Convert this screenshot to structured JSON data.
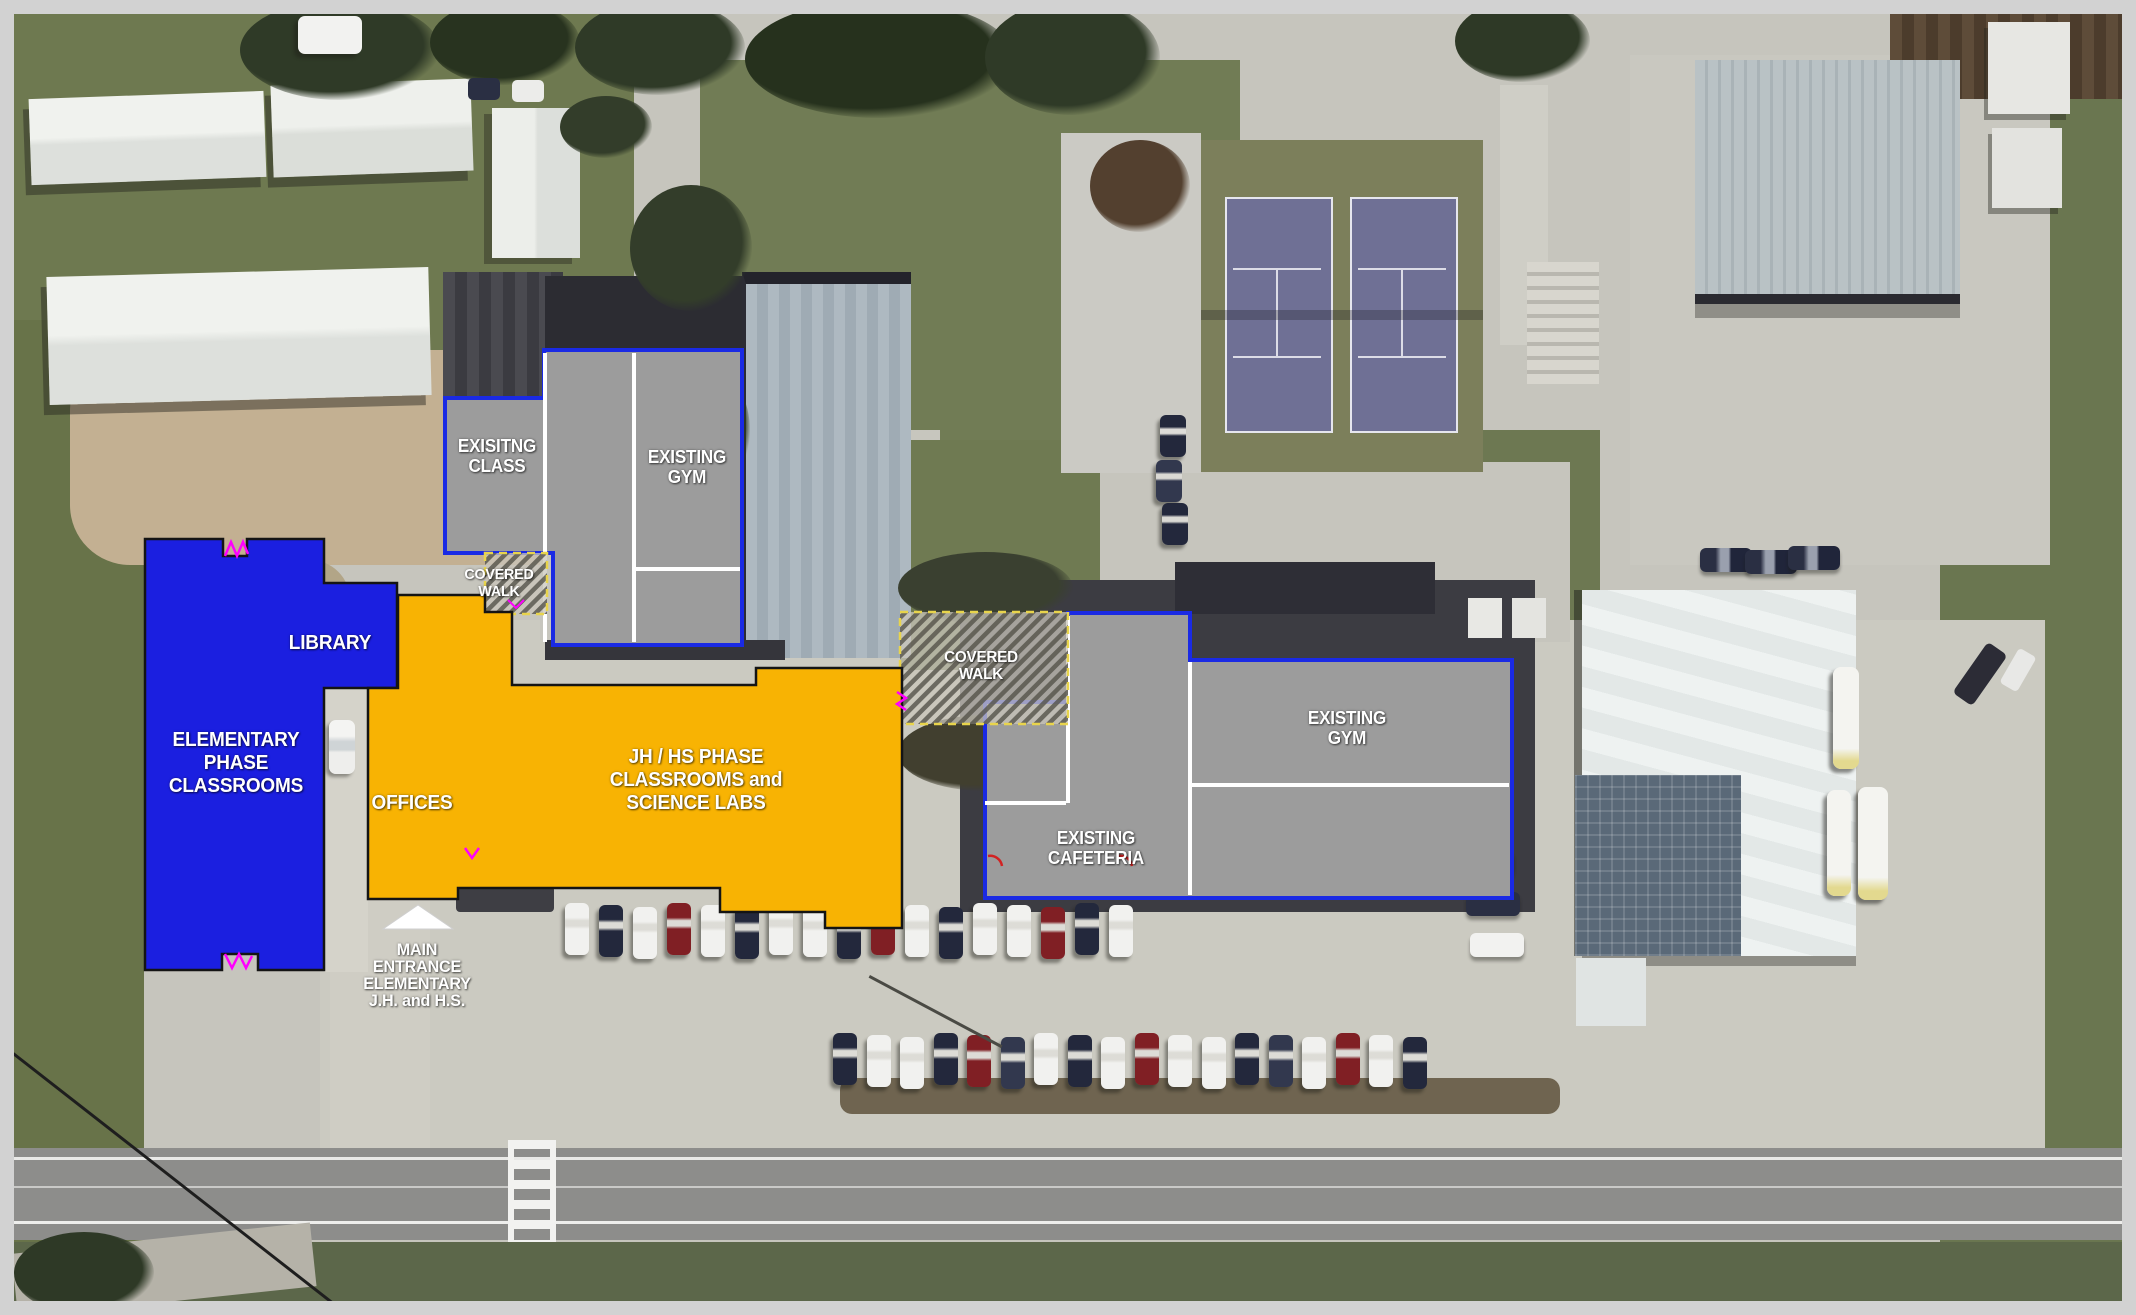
{
  "plan": {
    "colors": {
      "elementary_fill": "#1b1fe0",
      "jh_hs_fill": "#f8b303",
      "existing_fill": "#9c9c9c",
      "existing_outline": "#1a2ae4",
      "new_outline": "#141414",
      "covered_walk_dash": "#e8d44c",
      "divider_line": "#ffffff",
      "door_mark": "#ff00ff",
      "door_mark_alt": "#d22222",
      "entrance_arrow": "#ffffff",
      "label_text": "#ffffff"
    },
    "areas": {
      "existing_class": {
        "type": "existing",
        "l1": "EXISITNG",
        "l2": "CLASS"
      },
      "existing_gym_north": {
        "type": "existing",
        "l1": "EXISTING",
        "l2": "GYM"
      },
      "covered_walk_north": {
        "type": "covered-walk",
        "l1": "COVERED",
        "l2": "WALK"
      },
      "library": {
        "type": "elementary-phase",
        "l1": "LIBRARY"
      },
      "elementary_classrooms": {
        "type": "elementary-phase",
        "l1": "ELEMENTARY",
        "l2": "PHASE",
        "l3": "CLASSROOMS"
      },
      "offices": {
        "type": "jh-hs-phase",
        "l1": "OFFICES"
      },
      "jh_hs_classrooms": {
        "type": "jh-hs-phase",
        "l1": "JH / HS PHASE",
        "l2": "CLASSROOMS and",
        "l3": "SCIENCE LABS"
      },
      "covered_walk_central": {
        "type": "covered-walk",
        "l1": "COVERED",
        "l2": "WALK"
      },
      "existing_gym_east": {
        "type": "existing",
        "l1": "EXISTING",
        "l2": "GYM"
      },
      "existing_cafeteria": {
        "type": "existing",
        "l1": "EXISTING",
        "l2": "CAFETERIA"
      },
      "main_entrance": {
        "type": "annotation",
        "l1": "MAIN",
        "l2": "ENTRANCE",
        "l3": "ELEMENTARY",
        "l4": "J.H. and H.S."
      }
    }
  }
}
